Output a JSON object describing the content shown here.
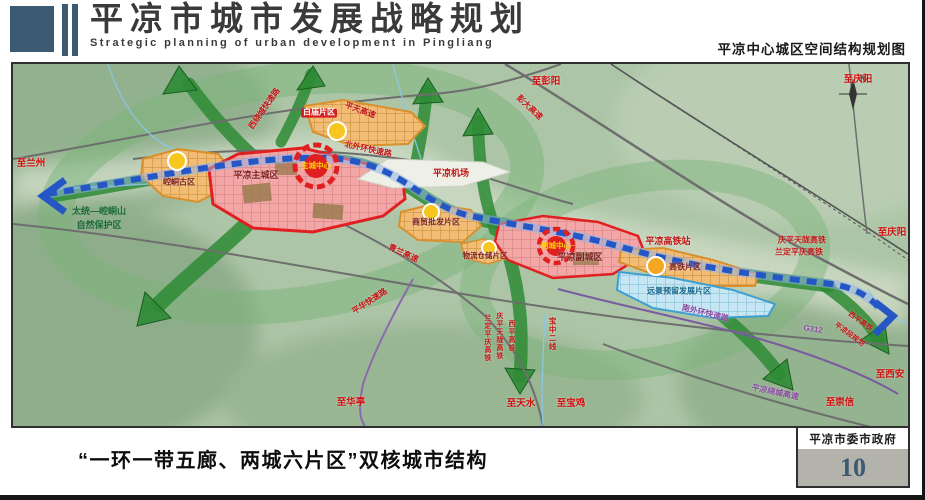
{
  "header": {
    "title": "平凉市城市发展战略规划",
    "subtitle_en": "Strategic planning of urban development in Pingliang",
    "map_title": "平凉中心城区空间结构规划图"
  },
  "footer": {
    "caption": "“一环一带五廊、两城六片区”双核城市结构",
    "organization": "平凉市委市政府",
    "page_number": "10"
  },
  "map": {
    "compass_label": "N",
    "colors": {
      "header_blue": "#3d5a73",
      "corridor_green": "#2e8b35",
      "ring_green": "#7ab37a",
      "rail_blue": "#2457c5",
      "zone_red_border": "#e02020",
      "zone_pink": "#f2a6a6",
      "zone_orange": "#f2bc74",
      "zone_blue": "#c5e6f2",
      "node_yellow": "#f7c71f"
    },
    "labels": {
      "zhi_lanzhou": "至兰州",
      "xi_raocheng": "西绕城快速路",
      "zhi_pengyang": "至彭阳",
      "zhi_qingyang_top": "至庆阳",
      "pengda_gaosu": "彭大高速",
      "pingtian_gaosu": "平天高速",
      "beiwaihuan": "北外环快速路",
      "baimiao": "白庙片区",
      "jichang": "平凉机场",
      "zhucheng_zhongxin": "主城中心",
      "zhuchengqu": "平凉主城区",
      "kongtong_guqu": "崆峒古区",
      "baohuqu_1": "太统—崆峒山",
      "baohuqu_2": "自然保护区",
      "shangmao": "商贸批发片区",
      "qinglan_gaosu": "青兰高速",
      "wuliu": "物流仓储片区",
      "fucheng_zhongxin": "副城中心",
      "fuchengqu": "平凉副城区",
      "gaotiezhan": "平凉高铁站",
      "gaotie_pianqu": "高铁片区",
      "yuanjing": "远景预留发展片区",
      "nanwaihuan": "南外环快速路",
      "qingping_tianlong": "庆平天陇高铁",
      "landing_pingqing": "兰定平庆高铁",
      "zhi_qingyang_right": "至庆阳",
      "g312": "G312",
      "xiping_gaotie": "西平高铁",
      "pingliang_duan": "平凉段规划",
      "zhi_xian": "至西安",
      "raocheng_gaosu": "平凉绕城高速",
      "zhi_chongxin": "至崇信",
      "rail_v1": "兰定平庆高铁",
      "rail_v2": "庆平天陇高铁",
      "rail_v3": "西平高铁",
      "baozhong": "宝中二线",
      "zhi_tianshui": "至天水",
      "zhi_baoji": "至宝鸡",
      "pinghua": "平华快速路",
      "zhi_huating": "至华亭"
    }
  }
}
